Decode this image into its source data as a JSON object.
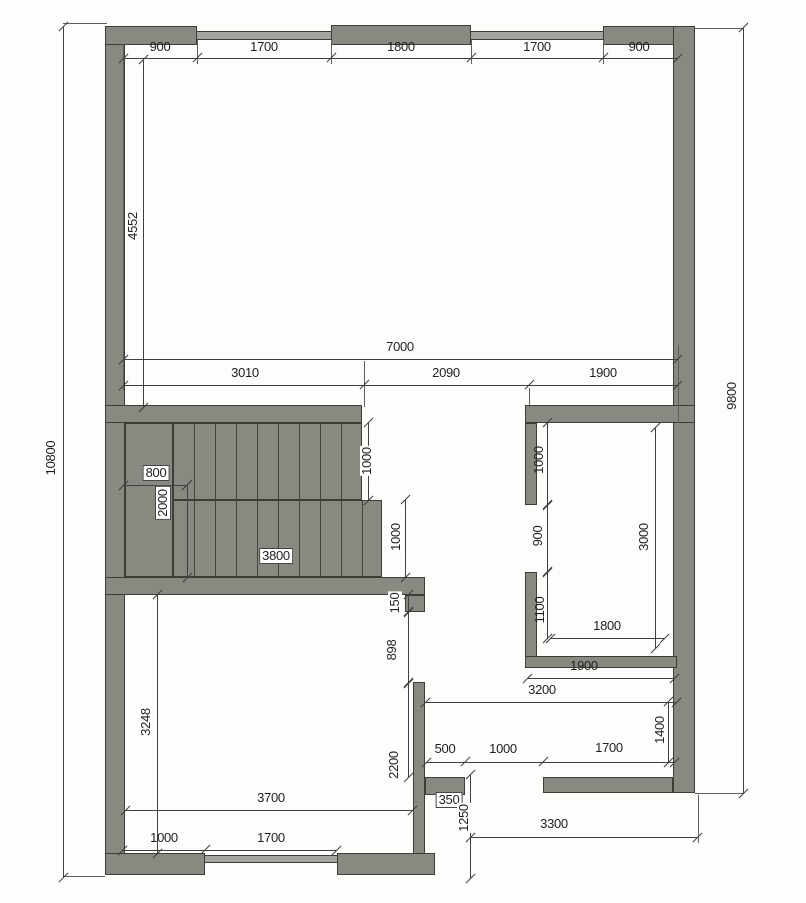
{
  "drawing": {
    "type": "architectural-floor-plan",
    "wall_color": "#868a80",
    "line_color": "#3f3f3f",
    "overall_dims": {
      "height_left": "10800",
      "height_right": "9800"
    },
    "top_dims": [
      "900",
      "1700",
      "1800",
      "1700",
      "900"
    ],
    "width_total": "7000",
    "width_segments": [
      "3010",
      "2090",
      "1900"
    ],
    "upper_room_height": "4552",
    "stairs": {
      "landing_width": "800",
      "landing_depth": "2000",
      "run_length": "3800",
      "upper_flight_width": "1000",
      "lower_flight_width": "1000"
    },
    "right_room": {
      "wall_top": "1000",
      "door": "900",
      "wall_bottom": "1100",
      "depth": "3000",
      "width_inner": "1800",
      "width_outer": "1900"
    },
    "hall": {
      "gap": "150",
      "opening": "898",
      "wall_height": "2200",
      "width": "3200",
      "right_offset": "1400",
      "door_side": "500",
      "door": "1000",
      "wall_right": "1700"
    },
    "bottom_room": {
      "depth": "3248",
      "width": "3700",
      "pier": "1000",
      "window": "1700"
    },
    "porch": {
      "stub": "350",
      "opening": "1250",
      "width": "3300"
    }
  }
}
